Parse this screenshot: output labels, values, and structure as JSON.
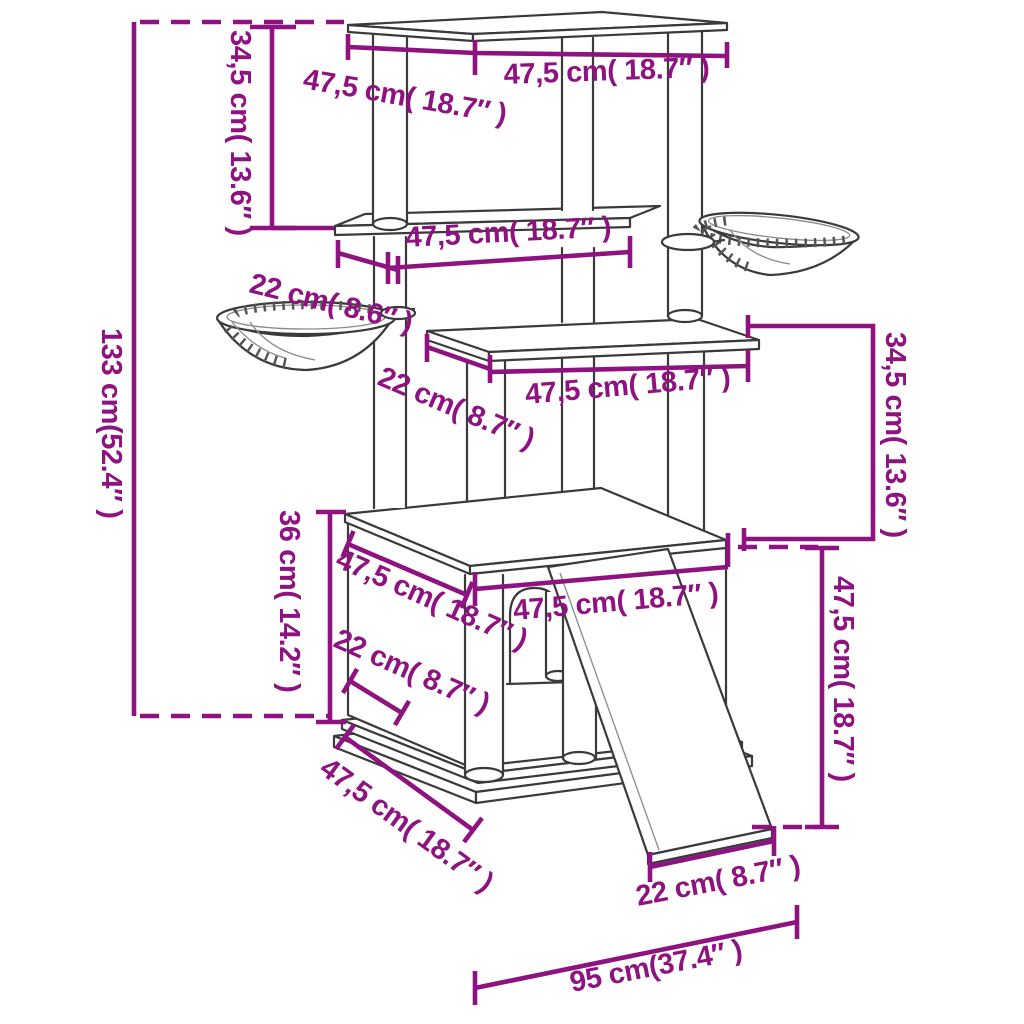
{
  "diagram": {
    "type": "product-dimension-diagram",
    "subject": "cat-tree-with-platforms-baskets-house-and-ramp",
    "background": "#ffffff"
  },
  "colors": {
    "dimension": "#8e1280",
    "outline": "#3a3a3a"
  },
  "dimensions": {
    "total_height": "133 cm(52.4″ )",
    "top_section_height": "34,5 cm( 13.6″ )",
    "top_platform_depth": "47,5 cm( 18.7″ )",
    "top_platform_width": "47,5 cm( 18.7″ )",
    "second_platform_width": "47,5 cm( 18.7″ )",
    "second_platform_depth": "22 cm( 8.6″ )",
    "third_platform_depth": "22 cm( 8.7″ )",
    "third_platform_width": "47,5 cm( 18.7″ )",
    "middle_section_height": "34,5 cm( 13.6″ )",
    "house_height": "36 cm( 14.2″ )",
    "house_top_depth": "47,5 cm( 18.7″ )",
    "house_opening_width": "22 cm( 8.7″ )",
    "house_top_width": "47,5 cm( 18.7″ )",
    "ramp_height": "47,5 cm( 18.7″ )",
    "base_depth": "47,5 cm( 18.7″ )",
    "ramp_width": "22 cm( 8.7″ )",
    "total_footprint_width": "95 cm(37.4″ )"
  }
}
